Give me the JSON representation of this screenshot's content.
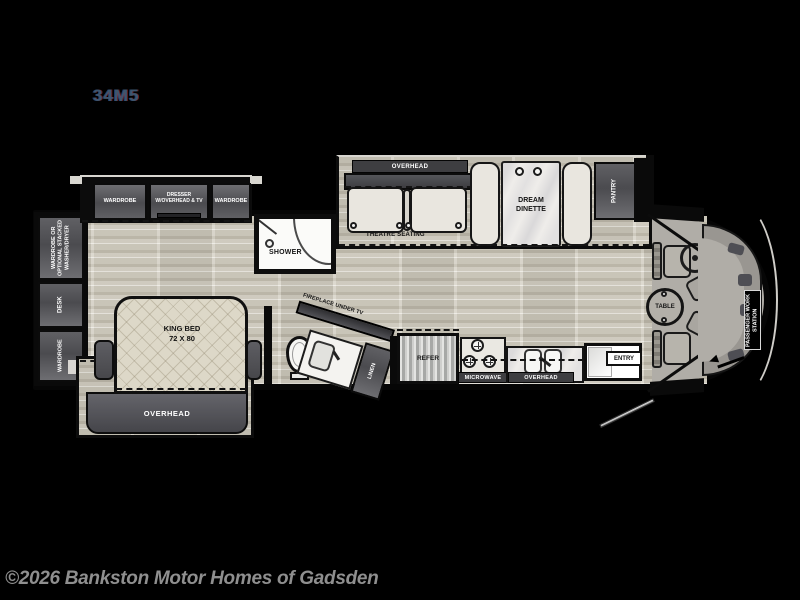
{
  "page": {
    "model": "34M5",
    "copyright": "©2026 Bankston Motor Homes of Gadsden"
  },
  "rear": {
    "washer_dryer": "WARDROBE OR OPTIONAL STACKED WASHER/DRYER",
    "desk": "DESK",
    "wardrobe": "WARDROBE"
  },
  "bedroom": {
    "wardrobe_left": "WARDROBE",
    "dresser": "DRESSER W/OVERHEAD & TV",
    "wardrobe_right": "WARDROBE",
    "bed_line1": "KING BED",
    "bed_line2": "72 X 80",
    "overhead": "OVERHEAD"
  },
  "bath": {
    "shower": "SHOWER",
    "linen": "LINEN",
    "fireplace": "FIREPLACE UNDER TV"
  },
  "living": {
    "overhead": "OVERHEAD",
    "theatre": "THEATRE SEATING",
    "dinette": "DREAM DINETTE",
    "pantry": "PANTRY"
  },
  "kitchen": {
    "refer": "REFER",
    "microwave": "MICROWAVE",
    "overhead": "OVERHEAD",
    "entry": "ENTRY"
  },
  "cockpit": {
    "table": "TABLE",
    "workstation": "PASSENGER WORK STATION"
  },
  "colors": {
    "floor_wood": "#c7c3b7",
    "cabinet": "#565659",
    "overhead_band": "#3e3e41",
    "seat": "#e9e6df",
    "marble": "#efedea",
    "body_outline": "#000000",
    "copyright_text": "#8f8f8f",
    "model_text": "#3d566e"
  }
}
